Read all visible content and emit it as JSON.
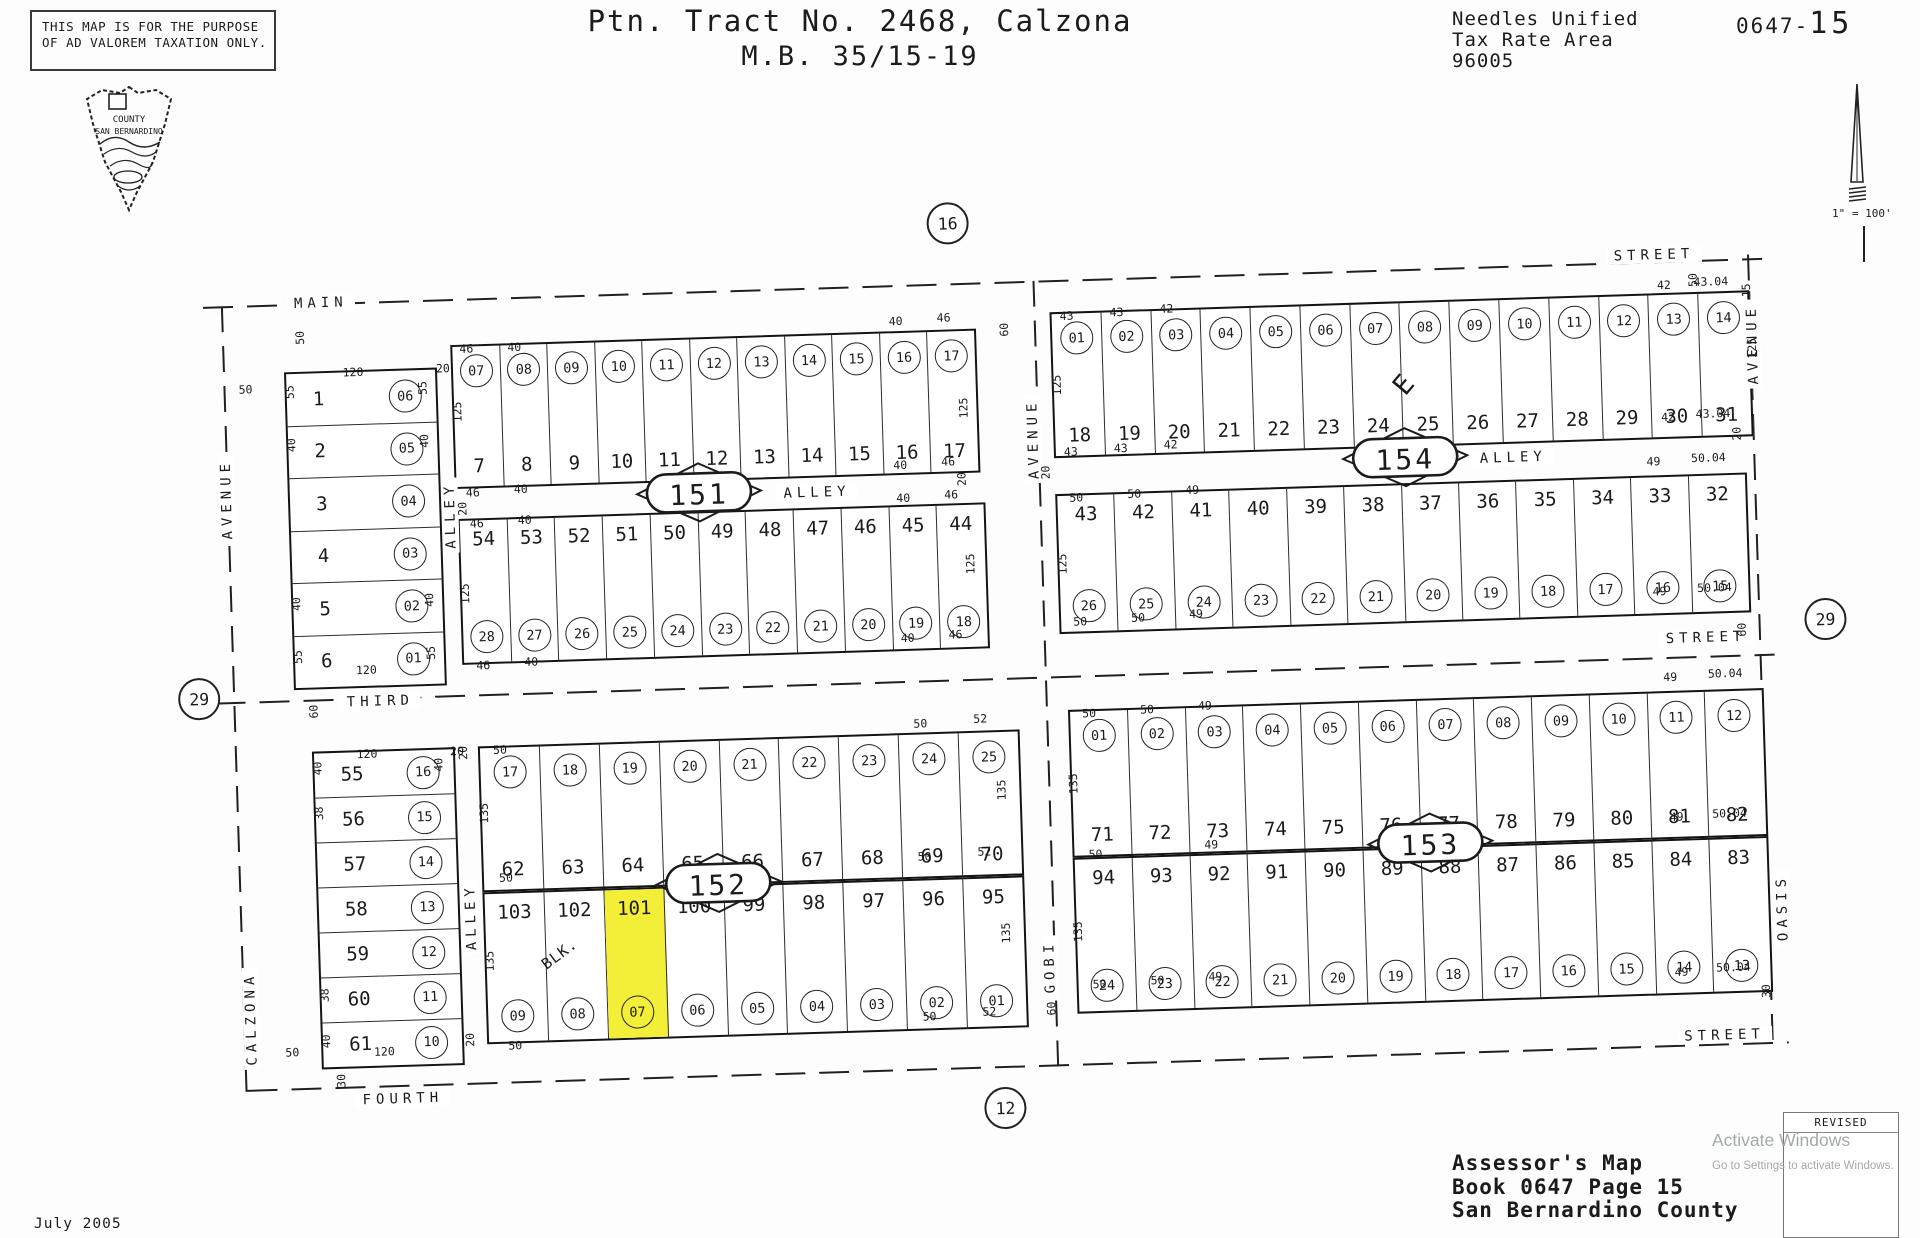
{
  "header": {
    "disclaimer1": "THIS MAP IS FOR THE PURPOSE",
    "disclaimer2": "OF AD VALOREM TAXATION ONLY.",
    "seal1": "COUNTY",
    "seal2": "SAN BERNARDINO",
    "title1": "Ptn. Tract No. 2468, Calzona",
    "title2": "M.B. 35/15-19",
    "tax1": "Needles Unified",
    "tax2": "Tax Rate Area",
    "tax3": "96005",
    "book_code": "0647-",
    "page_code": "15",
    "scale": "1\" = 100'"
  },
  "footer": {
    "line1": "Assessor's Map",
    "line2": "Book 0647 Page 15",
    "line3": "San Bernardino County",
    "date": "July 2005",
    "revised_label": "REVISED"
  },
  "watermark": {
    "line1": "Activate Windows",
    "line2": "Go to Settings to activate Windows."
  },
  "colors": {
    "highlight": "#f3ef39",
    "ink": "#1b1b1b",
    "watermark_gray": "#a4a9ac"
  },
  "map": {
    "junctions": [
      [
        "16",
        747,
        -28
      ],
      [
        "29",
        -16,
        424
      ],
      [
        "29",
        1612,
        395
      ],
      [
        "12",
        777,
        858
      ]
    ],
    "h_dashes": [
      [
        0,
        32,
        1560
      ],
      [
        0,
        428,
        1560
      ],
      [
        20,
        816,
        1542
      ]
    ],
    "v_dashes": [
      [
        18,
        32,
        786
      ],
      [
        830,
        32,
        786
      ],
      [
        1545,
        28,
        790
      ]
    ],
    "streets": [
      [
        "MAIN",
        118,
        32
      ],
      [
        "STREET",
        1452,
        26
      ],
      [
        "ALLEY",
        608,
        237
      ],
      [
        "ALLEY",
        1305,
        224
      ],
      [
        "THIRD",
        165,
        432
      ],
      [
        "STREET",
        1492,
        410
      ],
      [
        "FOURTH",
        175,
        830
      ],
      [
        "STREET",
        1498,
        808
      ]
    ],
    "v_streets": [
      [
        "AVENUE",
        18,
        225
      ],
      [
        "CALZONA",
        26,
        745
      ],
      [
        "ALLEY",
        241,
        248
      ],
      [
        "ALLEY",
        249,
        650
      ],
      [
        "AVENUE",
        826,
        190
      ],
      [
        "GOBI",
        826,
        718
      ],
      [
        "AVENUE",
        1548,
        118
      ],
      [
        "OASIS",
        1560,
        682
      ]
    ],
    "ovals": [
      [
        "151",
        490,
        237
      ],
      [
        "154",
        1197,
        224
      ],
      [
        "152",
        497,
        628
      ],
      [
        "153",
        1210,
        610
      ]
    ],
    "grids": [
      {
        "id": "lots-1-6",
        "x": 79,
        "y": 100,
        "w": 153,
        "h": 318,
        "type": "rows",
        "rows": [
          {
            "n": "1",
            "c": "06"
          },
          {
            "n": "2",
            "c": "05"
          },
          {
            "n": "3",
            "c": "04"
          },
          {
            "n": "4",
            "c": "03"
          },
          {
            "n": "5",
            "c": "02"
          },
          {
            "n": "6",
            "c": "01"
          }
        ]
      },
      {
        "id": "lots-55-61",
        "x": 95,
        "y": 480,
        "w": 143,
        "h": 318,
        "type": "rows",
        "rows": [
          {
            "n": "55",
            "c": "16"
          },
          {
            "n": "56",
            "c": "15"
          },
          {
            "n": "57",
            "c": "14"
          },
          {
            "n": "58",
            "c": "13"
          },
          {
            "n": "59",
            "c": "12"
          },
          {
            "n": "60",
            "c": "11"
          },
          {
            "n": "61",
            "c": "10"
          }
        ]
      },
      {
        "id": "block-151-north",
        "x": 246,
        "y": 78,
        "w": 526,
        "h": 144,
        "type": "cols",
        "circles_pos": "top",
        "circles": [
          "07",
          "08",
          "09",
          "10",
          "11",
          "12",
          "13",
          "14",
          "15",
          "16",
          "17"
        ],
        "numbers": [
          "7",
          "8",
          "9",
          "10",
          "11",
          "12",
          "13",
          "14",
          "15",
          "16",
          "17"
        ]
      },
      {
        "id": "block-151-south",
        "x": 248,
        "y": 252,
        "w": 528,
        "h": 146,
        "type": "cols",
        "circles_pos": "bottom",
        "numbers": [
          "54",
          "53",
          "52",
          "51",
          "50",
          "49",
          "48",
          "47",
          "46",
          "45",
          "44"
        ],
        "circles": [
          "28",
          "27",
          "26",
          "25",
          "24",
          "23",
          "22",
          "21",
          "20",
          "19",
          "18"
        ]
      },
      {
        "id": "block-154-north",
        "x": 846,
        "y": 64,
        "w": 700,
        "h": 146,
        "type": "cols",
        "circles_pos": "top",
        "circles": [
          "01",
          "02",
          "03",
          "04",
          "05",
          "06",
          "07",
          "08",
          "09",
          "10",
          "11",
          "12",
          "13",
          "14"
        ],
        "numbers": [
          "18",
          "19",
          "20",
          "21",
          "22",
          "23",
          "24",
          "25",
          "26",
          "27",
          "28",
          "29",
          "30",
          "31"
        ]
      },
      {
        "id": "block-154-south",
        "x": 846,
        "y": 246,
        "w": 692,
        "h": 140,
        "type": "cols",
        "circles_pos": "bottom",
        "numbers": [
          "43",
          "42",
          "41",
          "40",
          "39",
          "38",
          "37",
          "36",
          "35",
          "34",
          "33",
          "32"
        ],
        "circles": [
          "26",
          "25",
          "24",
          "23",
          "22",
          "21",
          "20",
          "19",
          "18",
          "17",
          "16",
          "15"
        ]
      },
      {
        "id": "block-152-north",
        "x": 261,
        "y": 480,
        "w": 542,
        "h": 146,
        "type": "cols",
        "circles_pos": "top",
        "circles": [
          "17",
          "18",
          "19",
          "20",
          "21",
          "22",
          "23",
          "24",
          "25"
        ],
        "numbers": [
          "62",
          "63",
          "64",
          "65",
          "66",
          "67",
          "68",
          "69",
          "70"
        ]
      },
      {
        "id": "block-152-south",
        "x": 261,
        "y": 626,
        "w": 542,
        "h": 152,
        "type": "cols",
        "circles_pos": "bottom",
        "highlight": [
          2
        ],
        "numbers": [
          "103",
          "102",
          "101",
          "100",
          "99",
          "98",
          "97",
          "96",
          "95"
        ],
        "circles": [
          "09",
          "08",
          "07",
          "06",
          "05",
          "04",
          "03",
          "02",
          "01"
        ]
      },
      {
        "id": "block-153-north",
        "x": 852,
        "y": 462,
        "w": 696,
        "h": 148,
        "type": "cols",
        "circles_pos": "top",
        "circles": [
          "01",
          "02",
          "03",
          "04",
          "05",
          "06",
          "07",
          "08",
          "09",
          "10",
          "11",
          "12"
        ],
        "numbers": [
          "71",
          "72",
          "73",
          "74",
          "75",
          "76",
          "77",
          "78",
          "79",
          "80",
          "81",
          "82"
        ]
      },
      {
        "id": "block-153-south",
        "x": 852,
        "y": 610,
        "w": 696,
        "h": 156,
        "type": "cols",
        "circles_pos": "bottom",
        "numbers": [
          "94",
          "93",
          "92",
          "91",
          "90",
          "89",
          "88",
          "87",
          "86",
          "85",
          "84",
          "83"
        ],
        "circles": [
          "24",
          "23",
          "22",
          "21",
          "20",
          "19",
          "18",
          "17",
          "16",
          "15",
          "14",
          "13"
        ]
      }
    ],
    "dims": [
      [
        "50",
        96,
        66,
        -90
      ],
      [
        "50",
        40,
        116
      ],
      [
        "120",
        148,
        102
      ],
      [
        "20",
        238,
        101
      ],
      [
        "55",
        84,
        120,
        -90
      ],
      [
        "55",
        217,
        120,
        -90
      ],
      [
        "40",
        84,
        173,
        -90
      ],
      [
        "40",
        217,
        173,
        -90
      ],
      [
        "40",
        84,
        332,
        -90
      ],
      [
        "40",
        217,
        332,
        -90
      ],
      [
        "55",
        84,
        385,
        -90
      ],
      [
        "55",
        217,
        385,
        -90
      ],
      [
        "120",
        152,
        400
      ],
      [
        "120",
        150,
        484
      ],
      [
        "20",
        240,
        484
      ],
      [
        "40",
        100,
        497,
        -90
      ],
      [
        "40",
        221,
        497,
        -90
      ],
      [
        "38",
        100,
        542,
        -90
      ],
      [
        "38",
        100,
        724,
        -90
      ],
      [
        "40",
        100,
        770,
        -90
      ],
      [
        "120",
        158,
        782
      ],
      [
        "50",
        66,
        780
      ],
      [
        "30",
        114,
        810,
        -90
      ],
      [
        "46",
        262,
        82
      ],
      [
        "40",
        310,
        82
      ],
      [
        "40",
        692,
        68
      ],
      [
        "46",
        740,
        66
      ],
      [
        "125",
        251,
        145,
        -90
      ],
      [
        "125",
        757,
        157,
        -90
      ],
      [
        "46",
        264,
        226
      ],
      [
        "40",
        312,
        224
      ],
      [
        "40",
        692,
        212
      ],
      [
        "46",
        740,
        210
      ],
      [
        "20",
        253,
        242,
        -90
      ],
      [
        "20",
        753,
        228,
        -90
      ],
      [
        "46",
        267,
        257
      ],
      [
        "40",
        315,
        255
      ],
      [
        "40",
        694,
        245
      ],
      [
        "46",
        742,
        243
      ],
      [
        "125",
        253,
        327,
        -90
      ],
      [
        "125",
        759,
        313,
        -90
      ],
      [
        "46",
        269,
        399
      ],
      [
        "40",
        317,
        397
      ],
      [
        "40",
        694,
        385
      ],
      [
        "46",
        742,
        383
      ],
      [
        "43",
        863,
        68
      ],
      [
        "43",
        913,
        66
      ],
      [
        "42",
        963,
        64
      ],
      [
        "42",
        1461,
        56
      ],
      [
        "43.04",
        1508,
        54
      ],
      [
        "125",
        851,
        137,
        -90
      ],
      [
        "15",
        1543,
        64,
        -90
      ],
      [
        "125",
        1547,
        122,
        -90
      ],
      [
        "43",
        863,
        204
      ],
      [
        "43",
        913,
        202
      ],
      [
        "42",
        963,
        200
      ],
      [
        "42",
        1461,
        188
      ],
      [
        "43.04",
        1506,
        186
      ],
      [
        "20",
        837,
        224,
        -90
      ],
      [
        "20",
        1529,
        207,
        -90
      ],
      [
        "60",
        800,
        80,
        -90
      ],
      [
        "50",
        867,
        250
      ],
      [
        "50",
        925,
        248
      ],
      [
        "49",
        983,
        246
      ],
      [
        "49",
        1445,
        232
      ],
      [
        "50.04",
        1500,
        230
      ],
      [
        "125",
        851,
        316,
        -90
      ],
      [
        "50",
        867,
        374
      ],
      [
        "50",
        925,
        372
      ],
      [
        "49",
        983,
        370
      ],
      [
        "49",
        1447,
        362
      ],
      [
        "50.04",
        1502,
        360
      ],
      [
        "50",
        283,
        484
      ],
      [
        "50",
        704,
        471
      ],
      [
        "52",
        764,
        468
      ],
      [
        "135",
        265,
        547,
        -90
      ],
      [
        "135",
        783,
        540,
        -90
      ],
      [
        "50",
        285,
        612
      ],
      [
        "50",
        704,
        604
      ],
      [
        "52",
        764,
        601
      ],
      [
        "20",
        246,
        486,
        -90
      ],
      [
        "135",
        266,
        695,
        -90
      ],
      [
        "135",
        783,
        683,
        -90
      ],
      [
        "50",
        289,
        780
      ],
      [
        "50",
        704,
        764
      ],
      [
        "52",
        764,
        761
      ],
      [
        "20",
        244,
        773,
        -90
      ],
      [
        "BLK.",
        336,
        690,
        -35,
        "md"
      ],
      [
        "50",
        873,
        466
      ],
      [
        "50",
        931,
        464
      ],
      [
        "49",
        989,
        462
      ],
      [
        "49",
        1455,
        448
      ],
      [
        "50.04",
        1510,
        446
      ],
      [
        "135",
        855,
        536,
        -90
      ],
      [
        "50",
        875,
        607
      ],
      [
        "49",
        991,
        601
      ],
      [
        "49",
        1457,
        588
      ],
      [
        "50.04",
        1510,
        586
      ],
      [
        "135",
        855,
        684,
        -90
      ],
      [
        "50",
        875,
        737
      ],
      [
        "50",
        933,
        735
      ],
      [
        "49",
        991,
        733
      ],
      [
        "49",
        1457,
        743
      ],
      [
        "50.04",
        1509,
        740
      ],
      [
        "30",
        1541,
        765,
        -90
      ],
      [
        "60",
        826,
        760,
        -90
      ],
      [
        "60",
        98,
        440,
        -90
      ],
      [
        "60",
        1528,
        403,
        -90
      ],
      [
        "50",
        1490,
        52,
        -90
      ],
      [
        "E",
        1198,
        148,
        -48,
        "lg"
      ]
    ]
  }
}
